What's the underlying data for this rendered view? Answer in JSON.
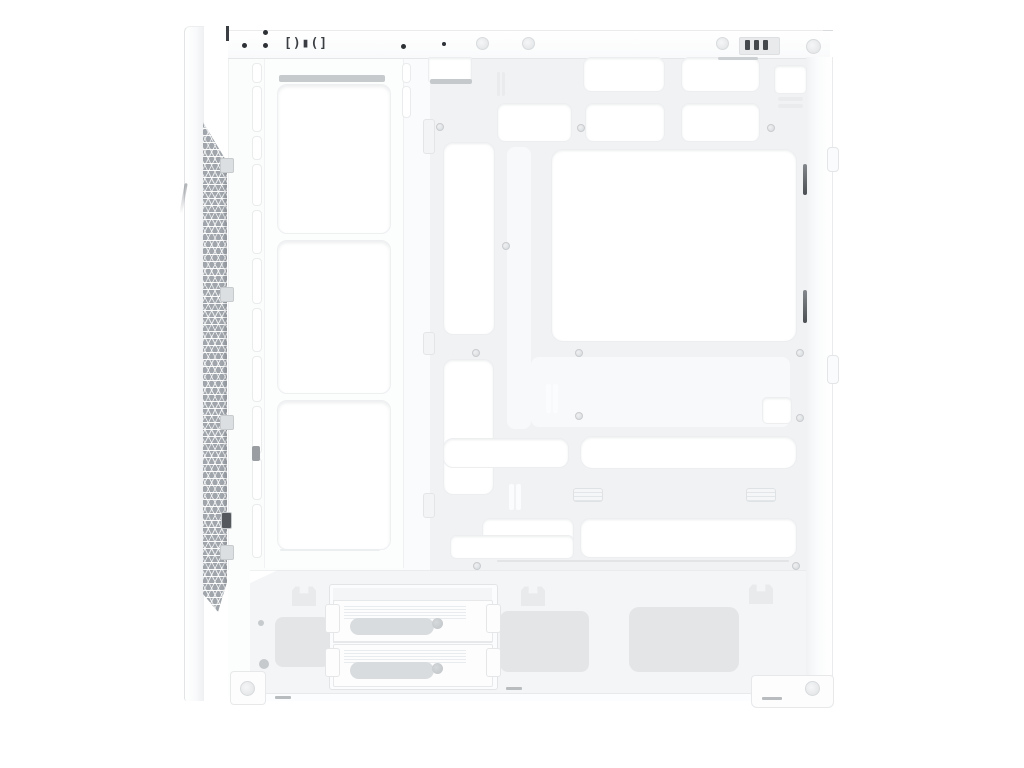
{
  "description": "White mid-tower PC case shown from the open side: front mesh strip, triple fan mounting bracket, motherboard tray with cable-routing cutouts, PSU shroud with 2-bay drive cage, on a plain white background. No visible text except a small port-shaped stamping on the top edge.",
  "palette": {
    "background": "#ffffff",
    "case_white": "#fdfdfe",
    "panel_line": "#e7e9eb",
    "tray_gray": "#f1f2f4",
    "shroud_gray": "#f4f5f6",
    "vent_gray": "#e3e5e7",
    "mesh_gray": "#a0a6ac",
    "dark_accent": "#45494d",
    "screw_gray": "#cdd0d3"
  },
  "top_panel": {
    "io_glyph": "[)▮(]",
    "black_dots": [
      {
        "x": 242,
        "y": 43,
        "d": 5
      },
      {
        "x": 263,
        "y": 30,
        "d": 5
      },
      {
        "x": 263,
        "y": 43,
        "d": 5
      },
      {
        "x": 401,
        "y": 44,
        "d": 5
      },
      {
        "x": 442,
        "y": 42,
        "d": 4
      }
    ],
    "surface_screws": [
      {
        "x": 476,
        "y": 37,
        "d": 11
      },
      {
        "x": 522,
        "y": 37,
        "d": 11
      },
      {
        "x": 716,
        "y": 37,
        "d": 11
      },
      {
        "x": 806,
        "y": 39,
        "d": 13
      }
    ],
    "rear_slot_bars": [
      {
        "x": 745,
        "y": 40,
        "w": 5,
        "h": 10
      },
      {
        "x": 754,
        "y": 40,
        "w": 5,
        "h": 10
      },
      {
        "x": 763,
        "y": 40,
        "w": 5,
        "h": 10
      }
    ]
  },
  "front_panel": {
    "mesh_clips": [
      {
        "x": 220,
        "y": 158,
        "w": 12,
        "h": 13
      },
      {
        "x": 220,
        "y": 287,
        "w": 12,
        "h": 13
      },
      {
        "x": 220,
        "y": 415,
        "w": 12,
        "h": 13
      },
      {
        "x": 220,
        "y": 545,
        "w": 12,
        "h": 13
      },
      {
        "x": 221,
        "y": 512,
        "w": 9,
        "h": 15,
        "fill": "#55585c"
      }
    ]
  },
  "interior": {
    "wall_slots": [
      {
        "x": 252,
        "y": 63,
        "w": 8,
        "h": 18
      },
      {
        "x": 252,
        "y": 86,
        "w": 8,
        "h": 44
      },
      {
        "x": 252,
        "y": 136,
        "w": 8,
        "h": 22
      },
      {
        "x": 252,
        "y": 164,
        "w": 8,
        "h": 40
      },
      {
        "x": 252,
        "y": 210,
        "w": 8,
        "h": 42
      },
      {
        "x": 252,
        "y": 258,
        "w": 8,
        "h": 44
      },
      {
        "x": 252,
        "y": 308,
        "w": 8,
        "h": 42
      },
      {
        "x": 252,
        "y": 356,
        "w": 8,
        "h": 44
      },
      {
        "x": 252,
        "y": 406,
        "w": 8,
        "h": 46
      },
      {
        "x": 252,
        "y": 458,
        "w": 8,
        "h": 40
      },
      {
        "x": 252,
        "y": 504,
        "w": 8,
        "h": 52
      },
      {
        "x": 402,
        "y": 63,
        "w": 7,
        "h": 18
      },
      {
        "x": 402,
        "y": 86,
        "w": 7,
        "h": 30
      }
    ],
    "fan_openings": [
      {
        "x": 277,
        "y": 84,
        "w": 112,
        "h": 148
      },
      {
        "x": 277,
        "y": 240,
        "w": 112,
        "h": 152
      },
      {
        "x": 277,
        "y": 400,
        "w": 112,
        "h": 148
      }
    ],
    "edge_tabs": [
      {
        "x": 423,
        "y": 119,
        "w": 10,
        "h": 33
      },
      {
        "x": 423,
        "y": 332,
        "w": 10,
        "h": 21
      },
      {
        "x": 423,
        "y": 493,
        "w": 10,
        "h": 23
      }
    ]
  },
  "tray": {
    "cutouts": [
      {
        "x": 428,
        "y": 57,
        "w": 42,
        "h": 23,
        "r": 2
      },
      {
        "x": 583,
        "y": 57,
        "w": 80,
        "h": 33,
        "r": 8
      },
      {
        "x": 681,
        "y": 57,
        "w": 77,
        "h": 33,
        "r": 8
      },
      {
        "x": 774,
        "y": 65,
        "w": 31,
        "h": 27,
        "r": 5
      },
      {
        "x": 497,
        "y": 103,
        "w": 73,
        "h": 37,
        "r": 8
      },
      {
        "x": 585,
        "y": 103,
        "w": 78,
        "h": 37,
        "r": 8
      },
      {
        "x": 681,
        "y": 103,
        "w": 77,
        "h": 37,
        "r": 8
      },
      {
        "x": 551,
        "y": 149,
        "w": 244,
        "h": 191,
        "r": 12
      },
      {
        "x": 443,
        "y": 142,
        "w": 50,
        "h": 191,
        "r": 10
      },
      {
        "x": 443,
        "y": 359,
        "w": 49,
        "h": 134,
        "r": 10
      },
      {
        "x": 443,
        "y": 438,
        "w": 124,
        "h": 28,
        "r": 10
      },
      {
        "x": 580,
        "y": 436,
        "w": 215,
        "h": 31,
        "r": 12
      },
      {
        "x": 762,
        "y": 397,
        "w": 28,
        "h": 25,
        "r": 5
      },
      {
        "x": 482,
        "y": 518,
        "w": 90,
        "h": 38,
        "r": 8
      },
      {
        "x": 450,
        "y": 535,
        "w": 122,
        "h": 22,
        "r": 6
      },
      {
        "x": 580,
        "y": 518,
        "w": 215,
        "h": 38,
        "r": 10
      }
    ],
    "raised_panels": [
      {
        "x": 507,
        "y": 147,
        "w": 24,
        "h": 282
      },
      {
        "x": 531,
        "y": 357,
        "w": 259,
        "h": 70
      }
    ],
    "slot_bars": [
      {
        "x": 497,
        "y": 72,
        "w": 3,
        "h": 24
      },
      {
        "x": 502,
        "y": 72,
        "w": 3,
        "h": 24
      },
      {
        "x": 778,
        "y": 97,
        "w": 25,
        "h": 4
      },
      {
        "x": 778,
        "y": 104,
        "w": 25,
        "h": 4
      },
      {
        "x": 546,
        "y": 384,
        "w": 5,
        "h": 29,
        "fill": "#fbfcfd"
      },
      {
        "x": 553,
        "y": 384,
        "w": 5,
        "h": 29,
        "fill": "#fbfcfd"
      },
      {
        "x": 509,
        "y": 484,
        "w": 5,
        "h": 26,
        "fill": "#fbfcfd"
      },
      {
        "x": 516,
        "y": 484,
        "w": 5,
        "h": 26,
        "fill": "#fbfcfd"
      },
      {
        "x": 279,
        "y": 75,
        "w": 106,
        "h": 7,
        "fill": "#c7cacc"
      },
      {
        "x": 430,
        "y": 79,
        "w": 42,
        "h": 5,
        "fill": "#c6c9cb"
      },
      {
        "x": 718,
        "y": 57,
        "w": 40,
        "h": 3,
        "fill": "#cdd0d2"
      },
      {
        "x": 497,
        "y": 560,
        "w": 292,
        "h": 2,
        "fill": "#e2e4e6"
      },
      {
        "x": 280,
        "y": 549,
        "w": 100,
        "h": 2,
        "fill": "#eceff0"
      },
      {
        "x": 252,
        "y": 446,
        "w": 8,
        "h": 15,
        "fill": "#9a9ea2"
      }
    ],
    "outlined_slots": [
      {
        "x": 573,
        "y": 488,
        "w": 28,
        "h": 12
      },
      {
        "x": 746,
        "y": 488,
        "w": 28,
        "h": 12
      }
    ],
    "dark_slots": [
      {
        "x": 803,
        "y": 164,
        "w": 4,
        "h": 31
      },
      {
        "x": 803,
        "y": 290,
        "w": 4,
        "h": 33
      }
    ],
    "screw_holes": [
      {
        "x": 436,
        "y": 123,
        "d": 6
      },
      {
        "x": 577,
        "y": 124,
        "d": 6
      },
      {
        "x": 767,
        "y": 124,
        "d": 6
      },
      {
        "x": 502,
        "y": 242,
        "d": 6
      },
      {
        "x": 472,
        "y": 349,
        "d": 6
      },
      {
        "x": 575,
        "y": 349,
        "d": 6
      },
      {
        "x": 796,
        "y": 349,
        "d": 6
      },
      {
        "x": 575,
        "y": 412,
        "d": 6
      },
      {
        "x": 796,
        "y": 414,
        "d": 6
      },
      {
        "x": 473,
        "y": 562,
        "d": 6
      },
      {
        "x": 792,
        "y": 562,
        "d": 6
      }
    ]
  },
  "right_wall": {
    "handles": [
      {
        "x": 827,
        "y": 147,
        "w": 10,
        "h": 23
      },
      {
        "x": 827,
        "y": 355,
        "w": 10,
        "h": 27
      }
    ]
  },
  "shroud": {
    "crowns": [
      {
        "x": 292,
        "y": 585,
        "w": 24,
        "h": 21
      },
      {
        "x": 521,
        "y": 585,
        "w": 24,
        "h": 21
      },
      {
        "x": 749,
        "y": 583,
        "w": 24,
        "h": 21
      }
    ],
    "vents": [
      {
        "x": 275,
        "y": 617,
        "w": 55,
        "h": 50,
        "r": 8
      },
      {
        "x": 500,
        "y": 611,
        "w": 89,
        "h": 61,
        "r": 8
      },
      {
        "x": 629,
        "y": 607,
        "w": 110,
        "h": 65,
        "r": 10
      }
    ],
    "screws": [
      {
        "x": 258,
        "y": 620,
        "d": 6
      },
      {
        "x": 259,
        "y": 659,
        "d": 10
      }
    ],
    "dashes": [
      {
        "x": 506,
        "y": 687,
        "w": 16,
        "h": 3
      },
      {
        "x": 762,
        "y": 697,
        "w": 20,
        "h": 3
      },
      {
        "x": 275,
        "y": 696,
        "w": 16,
        "h": 3
      }
    ]
  },
  "drive_cage": {
    "trays": [
      {
        "x": 333,
        "y": 600,
        "w": 158,
        "h": 41
      },
      {
        "x": 333,
        "y": 644,
        "w": 158,
        "h": 41
      }
    ],
    "thumbscrews": [
      {
        "x": 432,
        "y": 618,
        "d": 11
      },
      {
        "x": 432,
        "y": 663,
        "d": 11
      }
    ],
    "side_tabs": [
      {
        "x": 325,
        "y": 604,
        "w": 13,
        "h": 27
      },
      {
        "x": 486,
        "y": 604,
        "w": 13,
        "h": 27
      },
      {
        "x": 325,
        "y": 648,
        "w": 13,
        "h": 27
      },
      {
        "x": 486,
        "y": 648,
        "w": 13,
        "h": 27
      }
    ]
  },
  "feet": {
    "screws": [
      {
        "x": 240,
        "y": 681,
        "d": 13
      },
      {
        "x": 805,
        "y": 681,
        "d": 13
      }
    ]
  }
}
